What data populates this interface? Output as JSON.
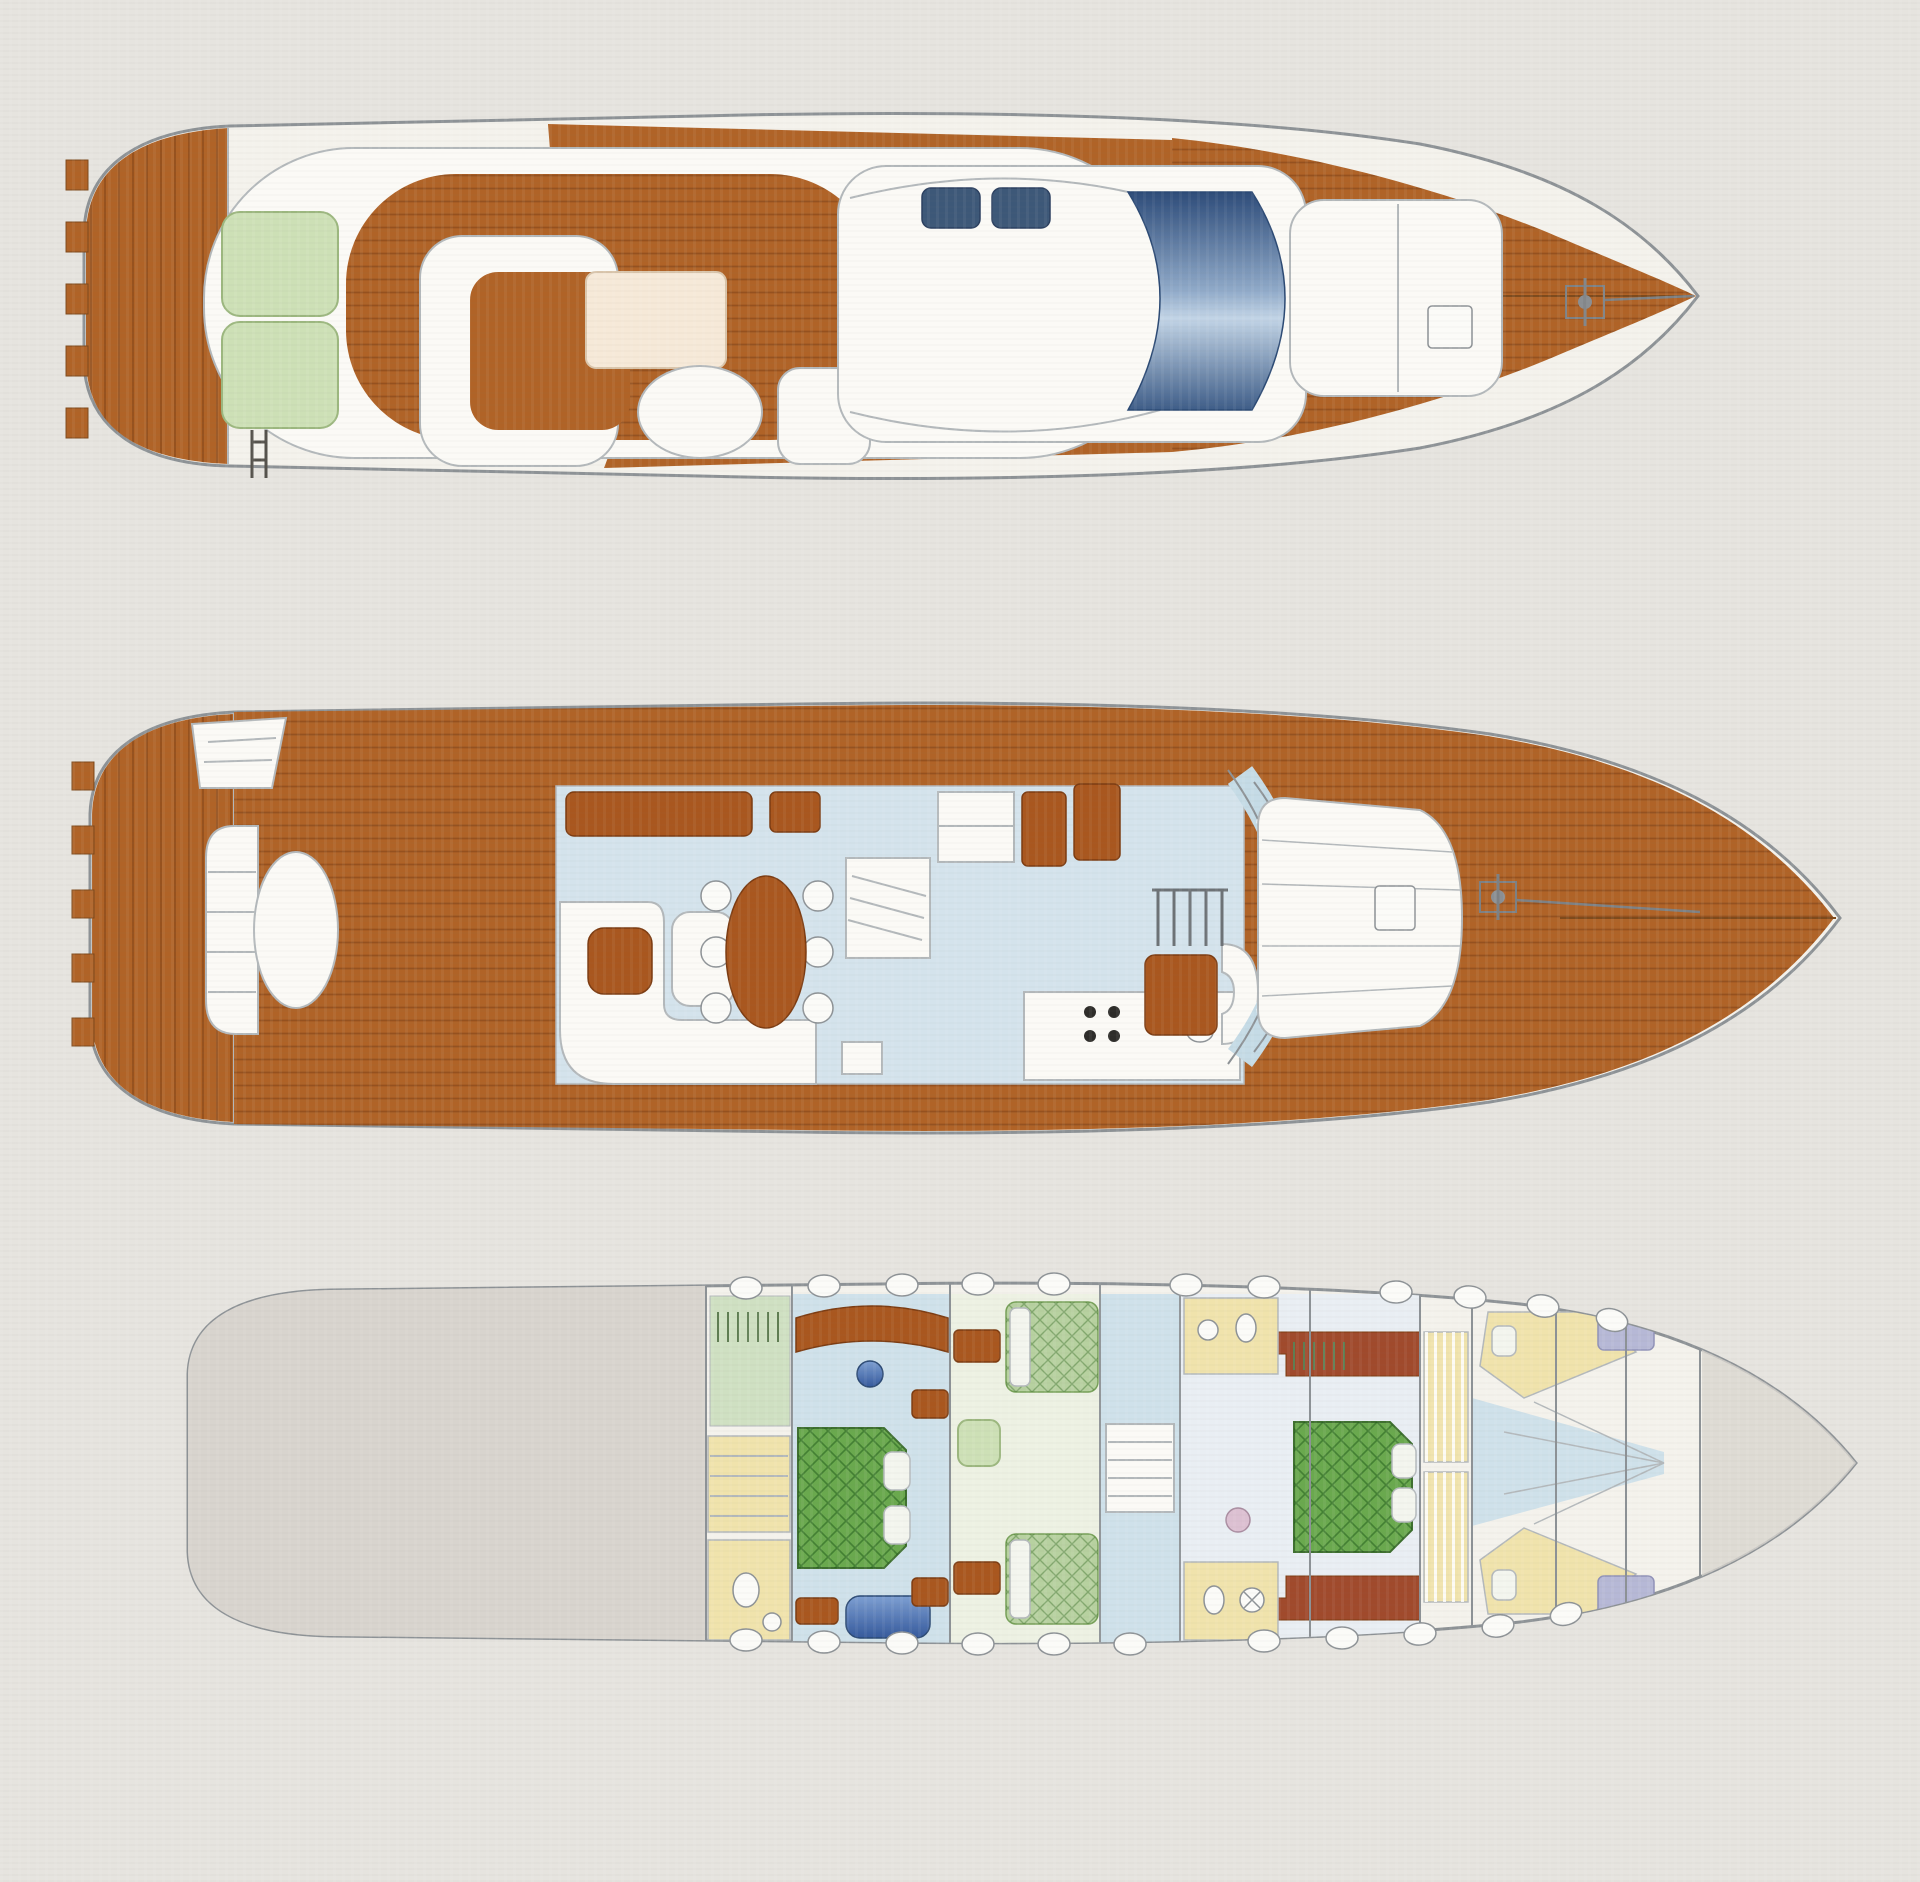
{
  "page": {
    "background": "#e6e4df",
    "content": "yacht deck plan drawing, three top-view decks stacked vertically, bows pointing right, no text labels"
  },
  "diagram": {
    "type": "yacht-deck-plan-triptych",
    "views": [
      {
        "id": "flybridge-deck",
        "position": "top"
      },
      {
        "id": "main-deck",
        "position": "middle"
      },
      {
        "id": "lower-deck",
        "position": "bottom"
      }
    ]
  },
  "palette": {
    "background": "#e6e4df",
    "hull_white": "#f4f2ec",
    "superstructure_white": "#fbfaf6",
    "outline_gray": "#8d9296",
    "outline_light": "#b3b8bb",
    "teak_brown": "#b06327",
    "teak_seam": "#7e4a1c",
    "furniture_wood": "#a9571f",
    "wall_redwood": "#a04a2c",
    "windshield_navy": "#2d4c7a",
    "windshield_light": "#c2d4e6",
    "seat_navy": "#3d5878",
    "cushion_green": "#cde0b6",
    "sunpad_cream": "#f6e9d8",
    "salon_floor_blue": "#d4e3ec",
    "corridor_blue": "#cfe1ea",
    "cabin_floor_sage": "#edf1e3",
    "vip_floor": "#e9eef3",
    "glass_blue": "#c5dbe6",
    "bed_green": "#6aa94e",
    "bed_green_light": "#b7d1a0",
    "bath_yellow": "#f0e3ac",
    "engine_gray": "#d8d4ce",
    "lavender": "#b6b8d6",
    "pillow_white": "#f3f5ee",
    "sofa_blue": "#4f79b8"
  }
}
